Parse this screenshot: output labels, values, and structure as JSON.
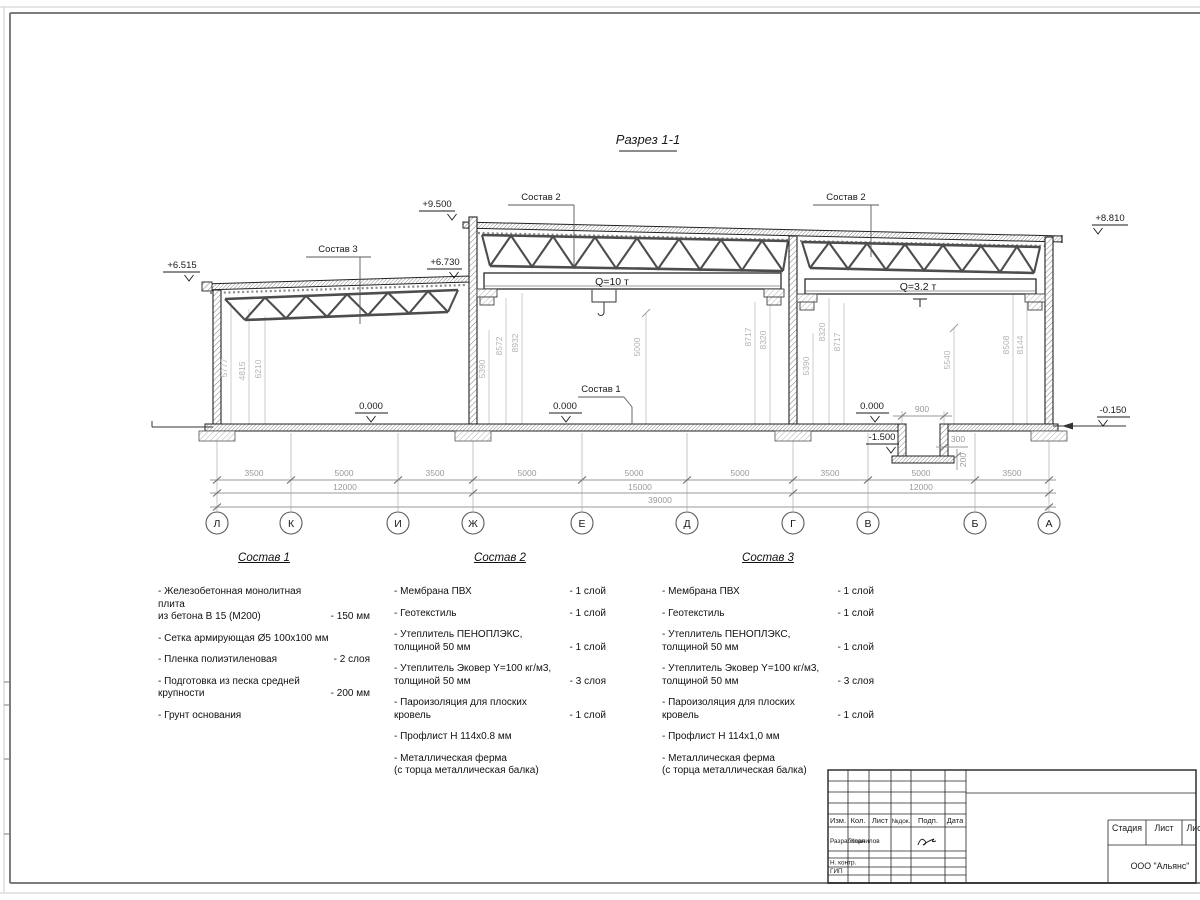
{
  "drawing": {
    "title": "Разрез 1-1",
    "labels": {
      "sostav1": "Состав 1",
      "sostav2_mid": "Состав 2",
      "sostav2_right": "Состав 2",
      "sostav3": "Состав 3"
    },
    "cranes": {
      "mid": "Q=10 т",
      "right": "Q=3.2 т"
    },
    "elevations": {
      "left_eave": "+6.515",
      "left_top": "+6.730",
      "mid_top": "+9.500",
      "right_top": "+8.810",
      "zero_left": "0.000",
      "zero_mid": "0.000",
      "zero_right": "0.000",
      "minus015": "-0.150",
      "minus150": "-1.500"
    },
    "vdims": {
      "l1": "5777",
      "l2": "4815",
      "l3": "6210",
      "m1": "5390",
      "m2": "8572",
      "m3": "8932",
      "m4": "5000",
      "m5": "8717",
      "m6": "8320",
      "r1": "5390",
      "r2": "8320",
      "r3": "8717",
      "r4": "5540",
      "r5": "8508",
      "r6": "8144"
    },
    "pit": {
      "width": "900",
      "d300": "300",
      "d200": "200"
    }
  },
  "dims": {
    "row1": [
      "3500",
      "5000",
      "3500",
      "5000",
      "5000",
      "5000",
      "3500",
      "5000",
      "3500"
    ],
    "row2": [
      "12000",
      "15000",
      "12000"
    ],
    "total": "39000"
  },
  "axes": [
    "Л",
    "К",
    "И",
    "Ж",
    "Е",
    "Д",
    "Г",
    "В",
    "Б",
    "А"
  ],
  "materials": [
    {
      "title": "Состав 1",
      "items": [
        {
          "name": "- Железобетонная  монолитная плита\nиз бетона В 15 (М200)",
          "qty": "- 150 мм"
        },
        {
          "name": "- Сетка армирующая Ø5 100х100 мм",
          "qty": ""
        },
        {
          "name": "- Пленка полиэтиленовая",
          "qty": "-  2 слоя"
        },
        {
          "name": "- Подготовка из песка средней\nкрупности",
          "qty": "- 200 мм"
        },
        {
          "name": "- Грунт основания",
          "qty": ""
        }
      ]
    },
    {
      "title": "Состав 2",
      "items": [
        {
          "name": "- Мембрана ПВХ",
          "qty": "- 1 слой"
        },
        {
          "name": "- Геотекстиль",
          "qty": "- 1 слой"
        },
        {
          "name": "- Утеплитель ПЕНОПЛЭКС,\nтолщиной 50 мм",
          "qty": "- 1 слой"
        },
        {
          "name": "- Утеплитель Эковер Y=100 кг/м3,\nтолщиной 50 мм",
          "qty": "- 3 слоя"
        },
        {
          "name": "- Пароизоляция для плоских кровель",
          "qty": "- 1 слой"
        },
        {
          "name": "- Профлист Н 114х0.8 мм",
          "qty": ""
        },
        {
          "name": "- Металлическая ферма\n(с торца металлическая балка)",
          "qty": ""
        }
      ]
    },
    {
      "title": "Состав 3",
      "items": [
        {
          "name": "- Мембрана ПВХ",
          "qty": "- 1 слой"
        },
        {
          "name": "- Геотекстиль",
          "qty": "- 1 слой"
        },
        {
          "name": "- Утеплитель ПЕНОПЛЭКС,\nтолщиной 50 мм",
          "qty": "- 1 слой"
        },
        {
          "name": "- Утеплитель Эковер Y=100 кг/м3,\nтолщиной 50 мм",
          "qty": "- 3 слоя"
        },
        {
          "name": "- Пароизоляция для плоских кровель",
          "qty": "- 1 слой"
        },
        {
          "name": "- Профлист Н 114х1,0 мм",
          "qty": ""
        },
        {
          "name": "- Металлическая ферма\n(с торца металлическая балка)",
          "qty": ""
        }
      ]
    }
  ],
  "titleblock": {
    "headers": {
      "izm": "Изм.",
      "kol": "Кол.",
      "list": "Лист",
      "ndok": "№док.",
      "podp": "Подп.",
      "data": "Дата"
    },
    "rows": {
      "razrabotal": "Разработал",
      "razrabotal_name": "Корнилов",
      "nkontr": "Н. контр.",
      "gip": "ГИП"
    },
    "right": {
      "stadia": "Стадия",
      "list": "Лист",
      "listov": "Лис",
      "company": "ООО \"Альянс\""
    }
  }
}
